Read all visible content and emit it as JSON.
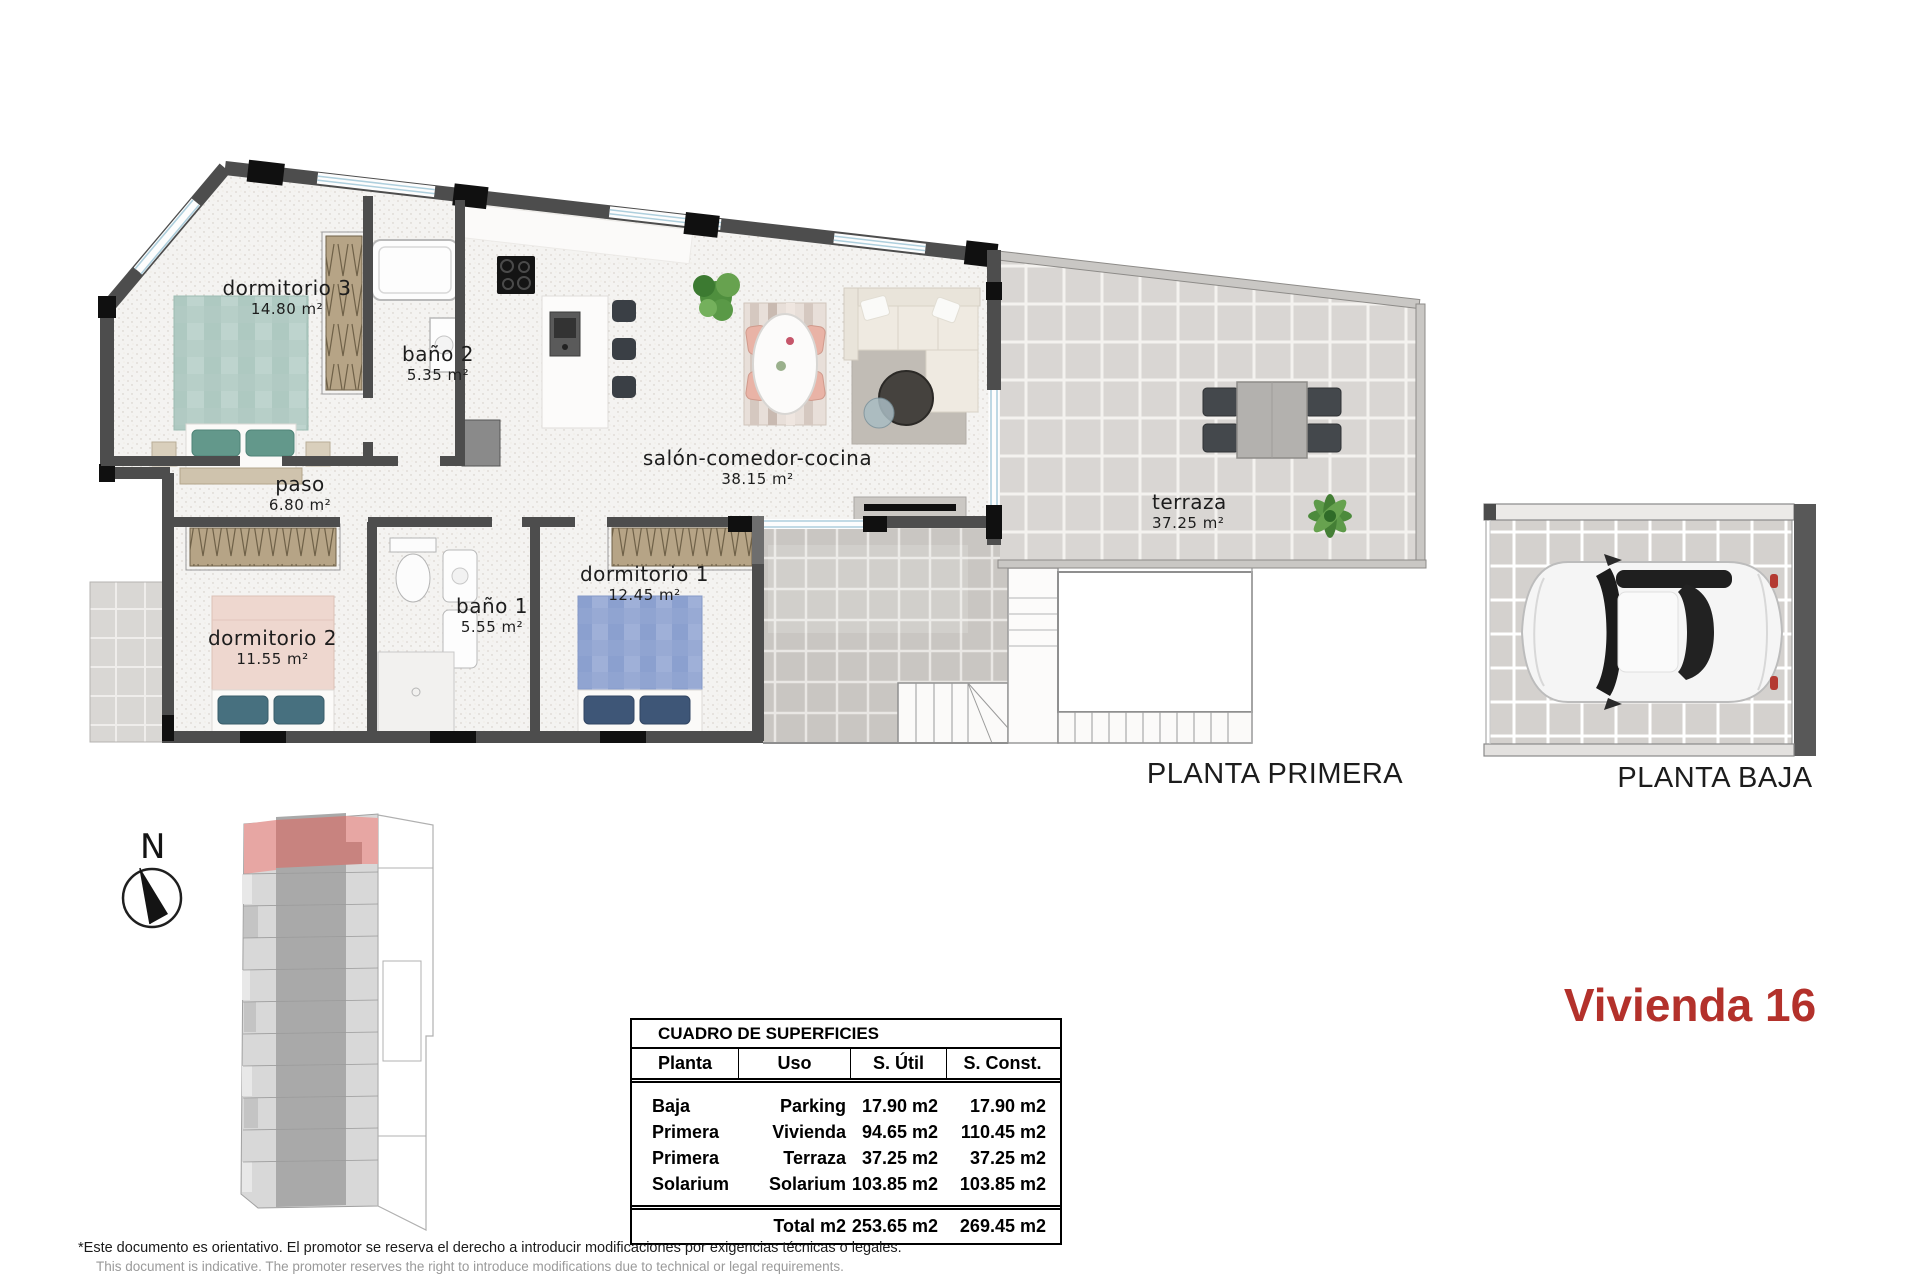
{
  "title": {
    "text": "Vivienda 16",
    "color": "#b3312b"
  },
  "plans": {
    "primera": {
      "label": "PLANTA PRIMERA",
      "rooms": [
        {
          "name": "dormitorio 3",
          "area": "14.80 m²"
        },
        {
          "name": "baño 2",
          "area": "5.35 m²"
        },
        {
          "name": "paso",
          "area": "6.80 m²"
        },
        {
          "name": "salón-comedor-cocina",
          "area": "38.15 m²"
        },
        {
          "name": "terraza",
          "area": "37.25 m²"
        },
        {
          "name": "dormitorio 2",
          "area": "11.55 m²"
        },
        {
          "name": "baño 1",
          "area": "5.55 m²"
        },
        {
          "name": "dormitorio 1",
          "area": "12.45 m²"
        }
      ]
    },
    "baja": {
      "label": "PLANTA BAJA"
    }
  },
  "compass": {
    "label": "N"
  },
  "surface_table": {
    "title": "CUADRO DE SUPERFICIES",
    "headers": [
      "Planta",
      "Uso",
      "S. Útil",
      "S. Const."
    ],
    "rows": [
      [
        "Baja",
        "Parking",
        "17.90 m2",
        "17.90 m2"
      ],
      [
        "Primera",
        "Vivienda",
        "94.65 m2",
        "110.45 m2"
      ],
      [
        "Primera",
        "Terraza",
        "37.25 m2",
        "37.25 m2"
      ],
      [
        "Solarium",
        "Solarium",
        "103.85 m2",
        "103.85 m2"
      ]
    ],
    "total": {
      "label": "Total m2",
      "util": "253.65 m2",
      "const": "269.45 m2"
    }
  },
  "disclaimer": {
    "es": "*Este documento es orientativo. El promotor se reserva el derecho a introducir modificaciones por exigencias técnicas o legales.",
    "en": "This document is indicative. The promoter reserves the right to introduce modifications due to technical or legal requirements."
  },
  "colors": {
    "wall": "#4d4d4d",
    "accent_red": "#b3312b",
    "site_highlight": "#e7a6a3",
    "site_highlight_dark": "#c8837f"
  }
}
